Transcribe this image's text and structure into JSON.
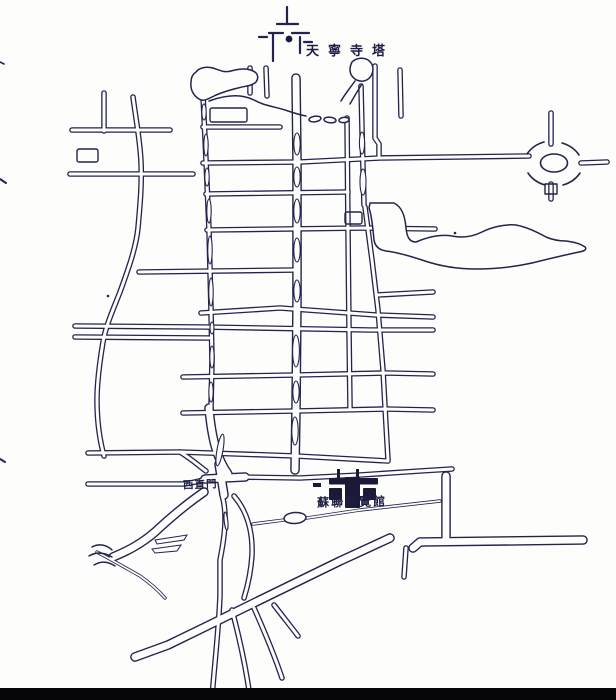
{
  "page": {
    "paper_color": "#fdfdfc",
    "ink_color": "#23234d",
    "scan_bar_color": "#050507"
  },
  "labels": {
    "pagoda": "天寧寺塔",
    "gate": "西直門",
    "exhibition_hall": "蘇聯展覽館"
  }
}
